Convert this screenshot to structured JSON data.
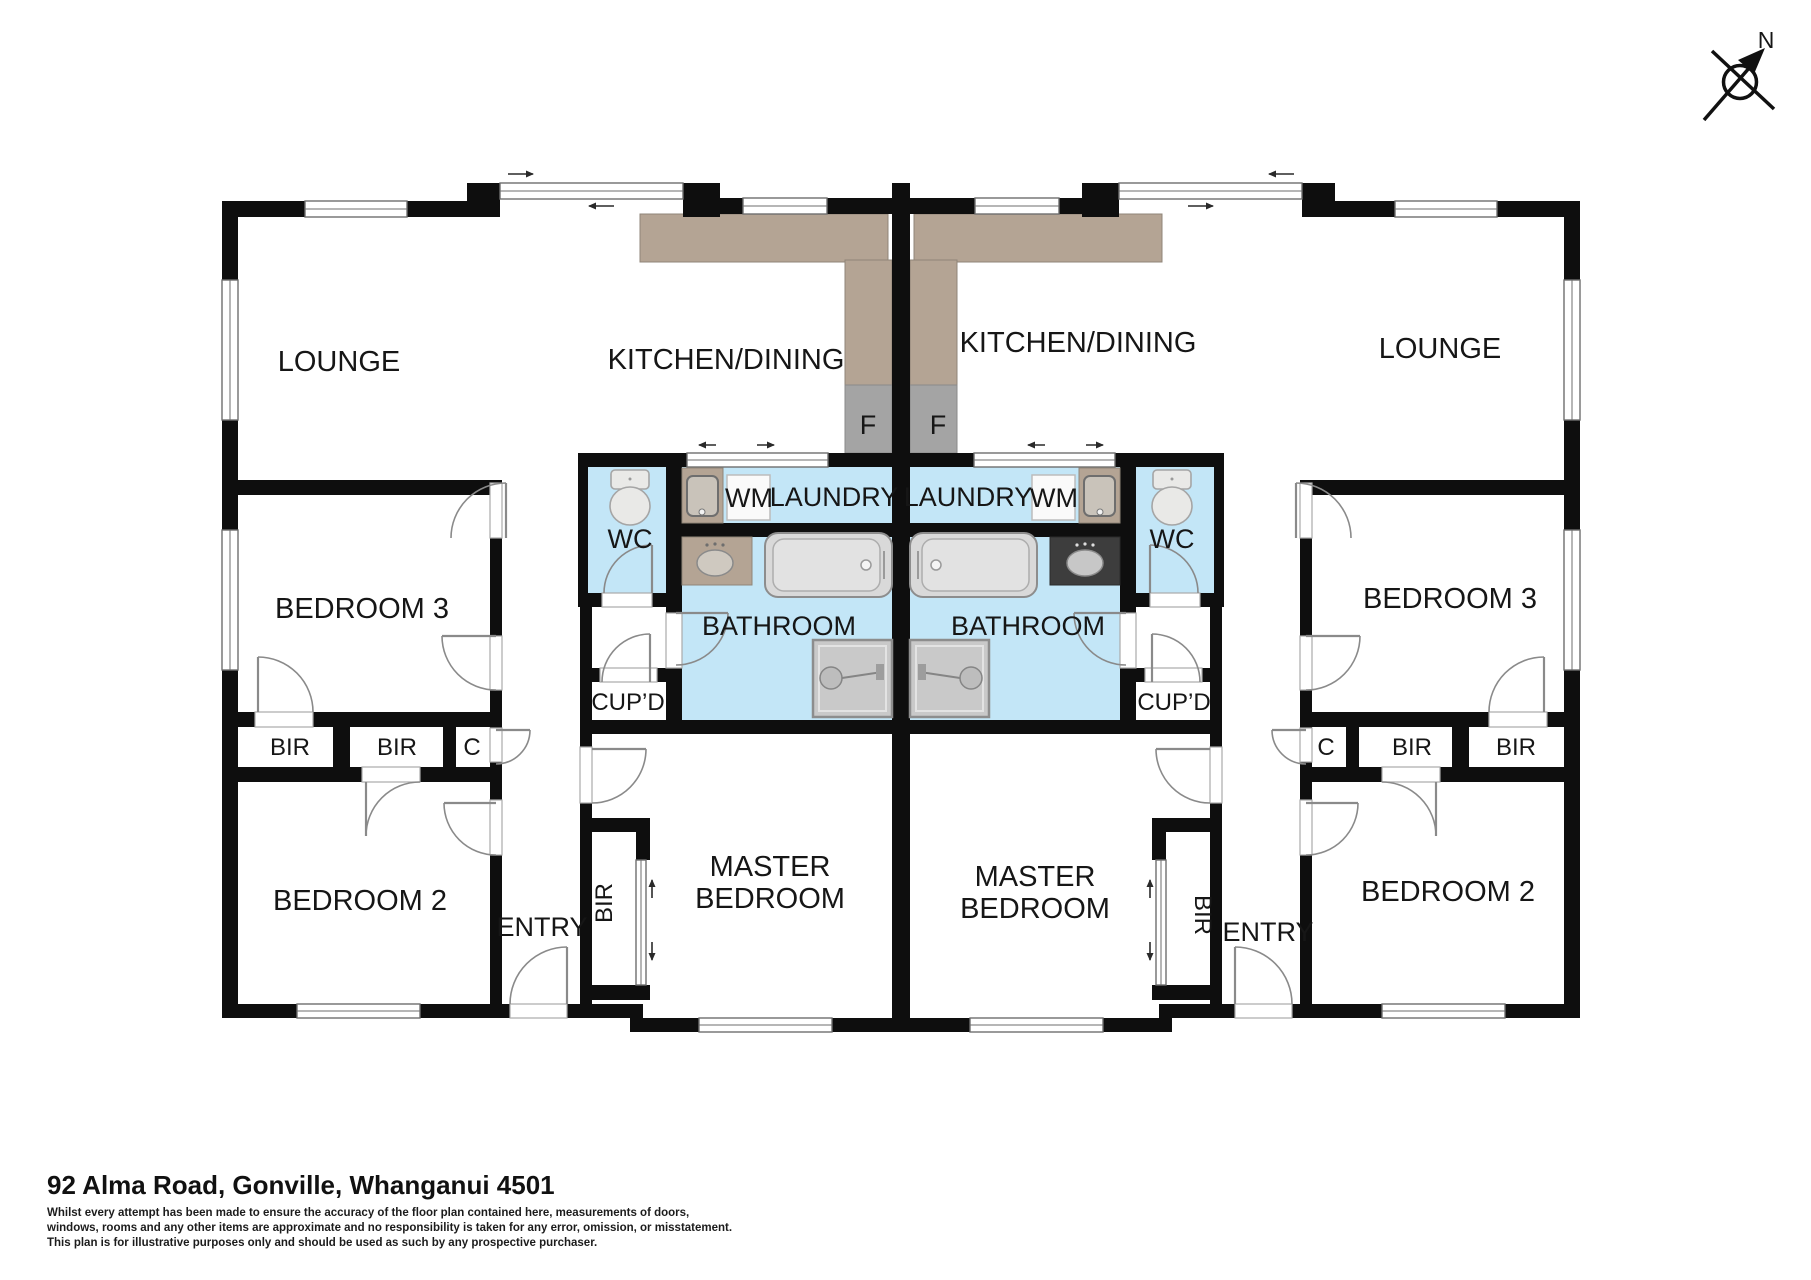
{
  "labels": {
    "lounge": "LOUNGE",
    "kitchen_dining": "KITCHEN/DINING",
    "laundry": "LAUNDRY",
    "washing_machine": "WM",
    "fridge": "F",
    "wc": "WC",
    "bathroom": "BATHROOM",
    "cupboard": "CUP’D",
    "bedroom3": "BEDROOM 3",
    "bedroom2": "BEDROOM 2",
    "built_in_robe": "BIR",
    "cupboard_c": "C",
    "entry": "ENTRY",
    "master_line1": "MASTER",
    "master_line2": "BEDROOM"
  },
  "compass": {
    "north_label": "N"
  },
  "footer": {
    "address": "92 Alma Road, Gonville, Whanganui 4501",
    "disclaimer": [
      "Whilst every attempt has been made to ensure the accuracy of the floor plan contained here, measurements of doors,",
      "windows, rooms and any other items are approximate and no responsibility is taken for any error, omission, or misstatement.",
      "This plan is for illustrative purposes only and should be used as such by any prospective purchaser."
    ]
  },
  "colors": {
    "wall": "#0e0e0e",
    "wet_floor": "#c3e6f7",
    "kitchen_counter": "#b4a494",
    "fridge_box": "#a4a4a4",
    "vanity_light": "#b4a494",
    "vanity_dark": "#3d3d3d",
    "fixture_fill": "#dcdcdc"
  }
}
